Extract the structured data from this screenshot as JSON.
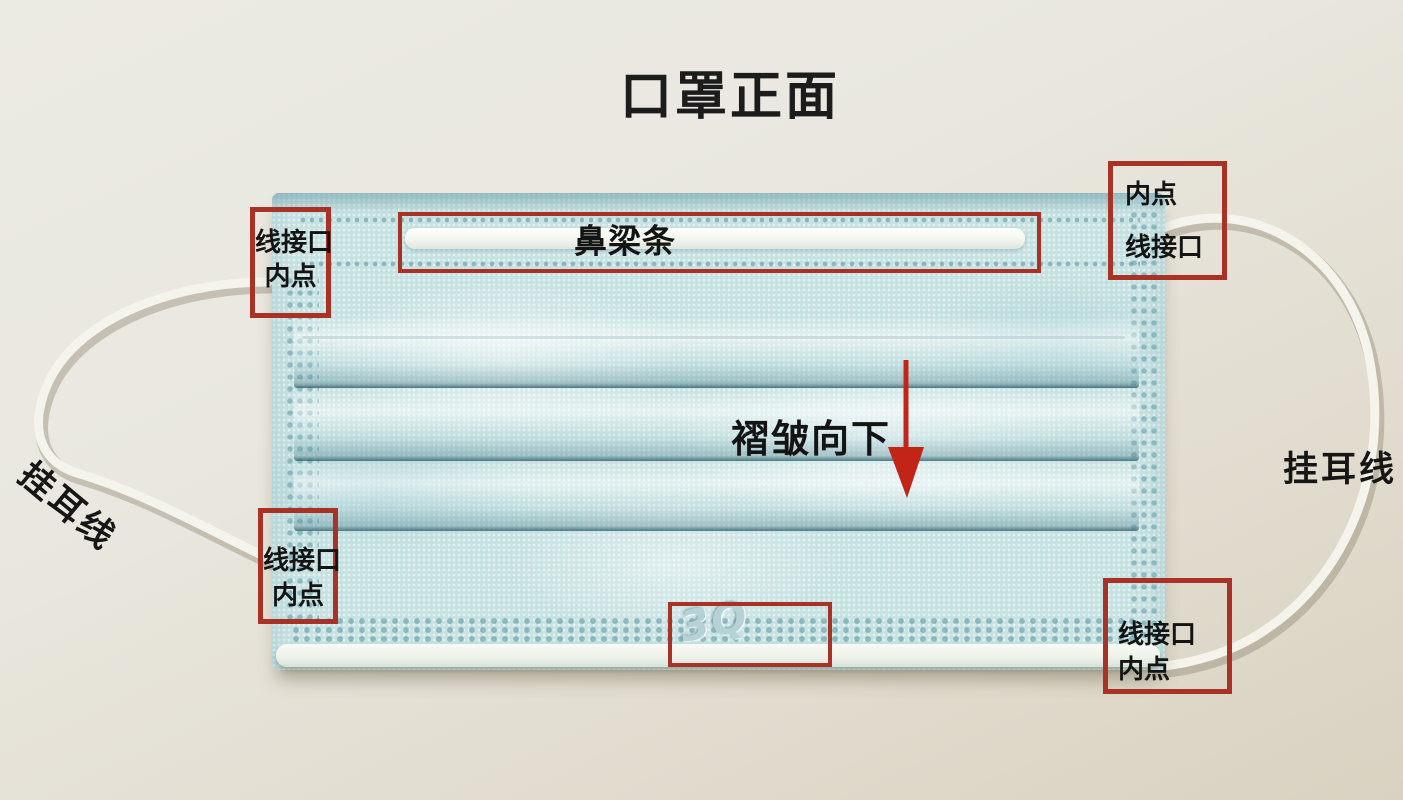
{
  "title": "口罩正面",
  "callouts": {
    "top_left": {
      "line1": "线接口",
      "line2": "内点"
    },
    "top_right": {
      "line1": "内点",
      "line2": "线接口"
    },
    "bottom_left": {
      "line1": "线接口",
      "line2": "内点"
    },
    "bottom_right": {
      "line1": "线接口",
      "line2": "内点"
    }
  },
  "labels": {
    "nose_bridge": "鼻梁条",
    "pleat_direction": "褶皱向下",
    "ear_line_left": "挂耳线",
    "ear_line_right": "挂耳线",
    "embossed_logo": "3Q"
  },
  "colors": {
    "annotation_box_red": "#a93226",
    "arrow_red": "#c22418",
    "mask_blue": "#c6e1e1",
    "background_beige": "#e7e4d9",
    "ear_loop_white": "#f4f3ec"
  }
}
